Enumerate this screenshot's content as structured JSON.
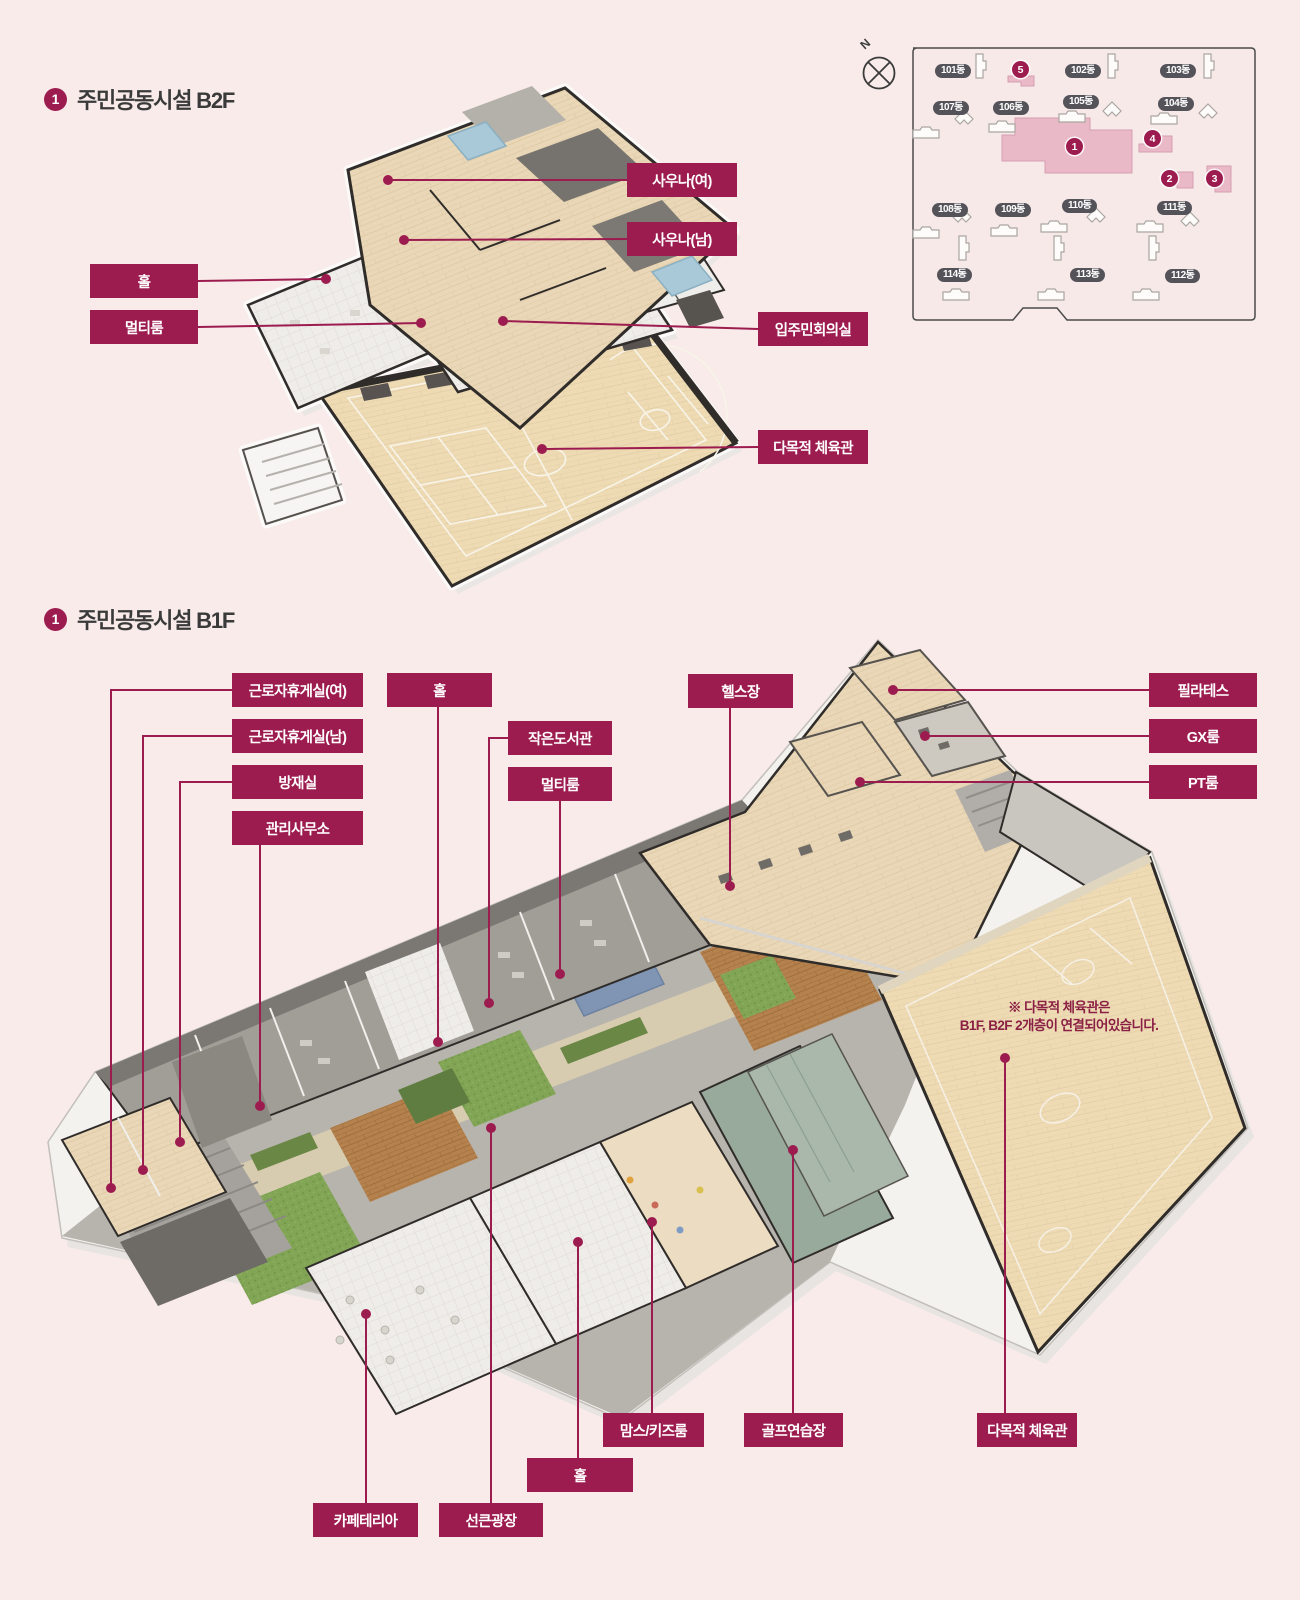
{
  "page": {
    "background": "#f8ebe9",
    "accent": "#9d1c4f"
  },
  "b2f": {
    "badge": "1",
    "title": "주민공동시설 B2F",
    "labels": {
      "sauna_female": "사우나(여)",
      "sauna_male": "사우나(남)",
      "hall": "홀",
      "multi_room": "멀티룸",
      "residents_meeting_room": "입주민회의실",
      "multipurpose_gym": "다목적 체육관"
    }
  },
  "b1f": {
    "badge": "1",
    "title": "주민공동시설 B1F",
    "labels": {
      "worker_lounge_female": "근로자휴게실(여)",
      "worker_lounge_male": "근로자휴게실(남)",
      "disaster_prevention_room": "방재실",
      "management_office": "관리사무소",
      "hall_top": "홀",
      "small_library": "작은도서관",
      "multi_room": "멀티룸",
      "fitness_center": "헬스장",
      "pilates": "필라테스",
      "gx_room": "GX룸",
      "pt_room": "PT룸",
      "moms_kids_room": "맘스/키즈룸",
      "golf_range": "골프연습장",
      "multipurpose_gym": "다목적 체육관",
      "hall_bottom": "홀",
      "cafeteria": "카페테리아",
      "sunken_plaza": "선큰광장"
    },
    "note": {
      "line1": "※ 다목적 체육관은",
      "line2": "B1F, B2F 2개층이 연결되어있습니다."
    }
  },
  "site_map": {
    "compass_label": "N",
    "buildings": [
      "101동",
      "102동",
      "103동",
      "107동",
      "106동",
      "105동",
      "104동",
      "108동",
      "109동",
      "110동",
      "111동",
      "114동",
      "113동",
      "112동"
    ],
    "badges": [
      "1",
      "2",
      "3",
      "4",
      "5"
    ]
  }
}
